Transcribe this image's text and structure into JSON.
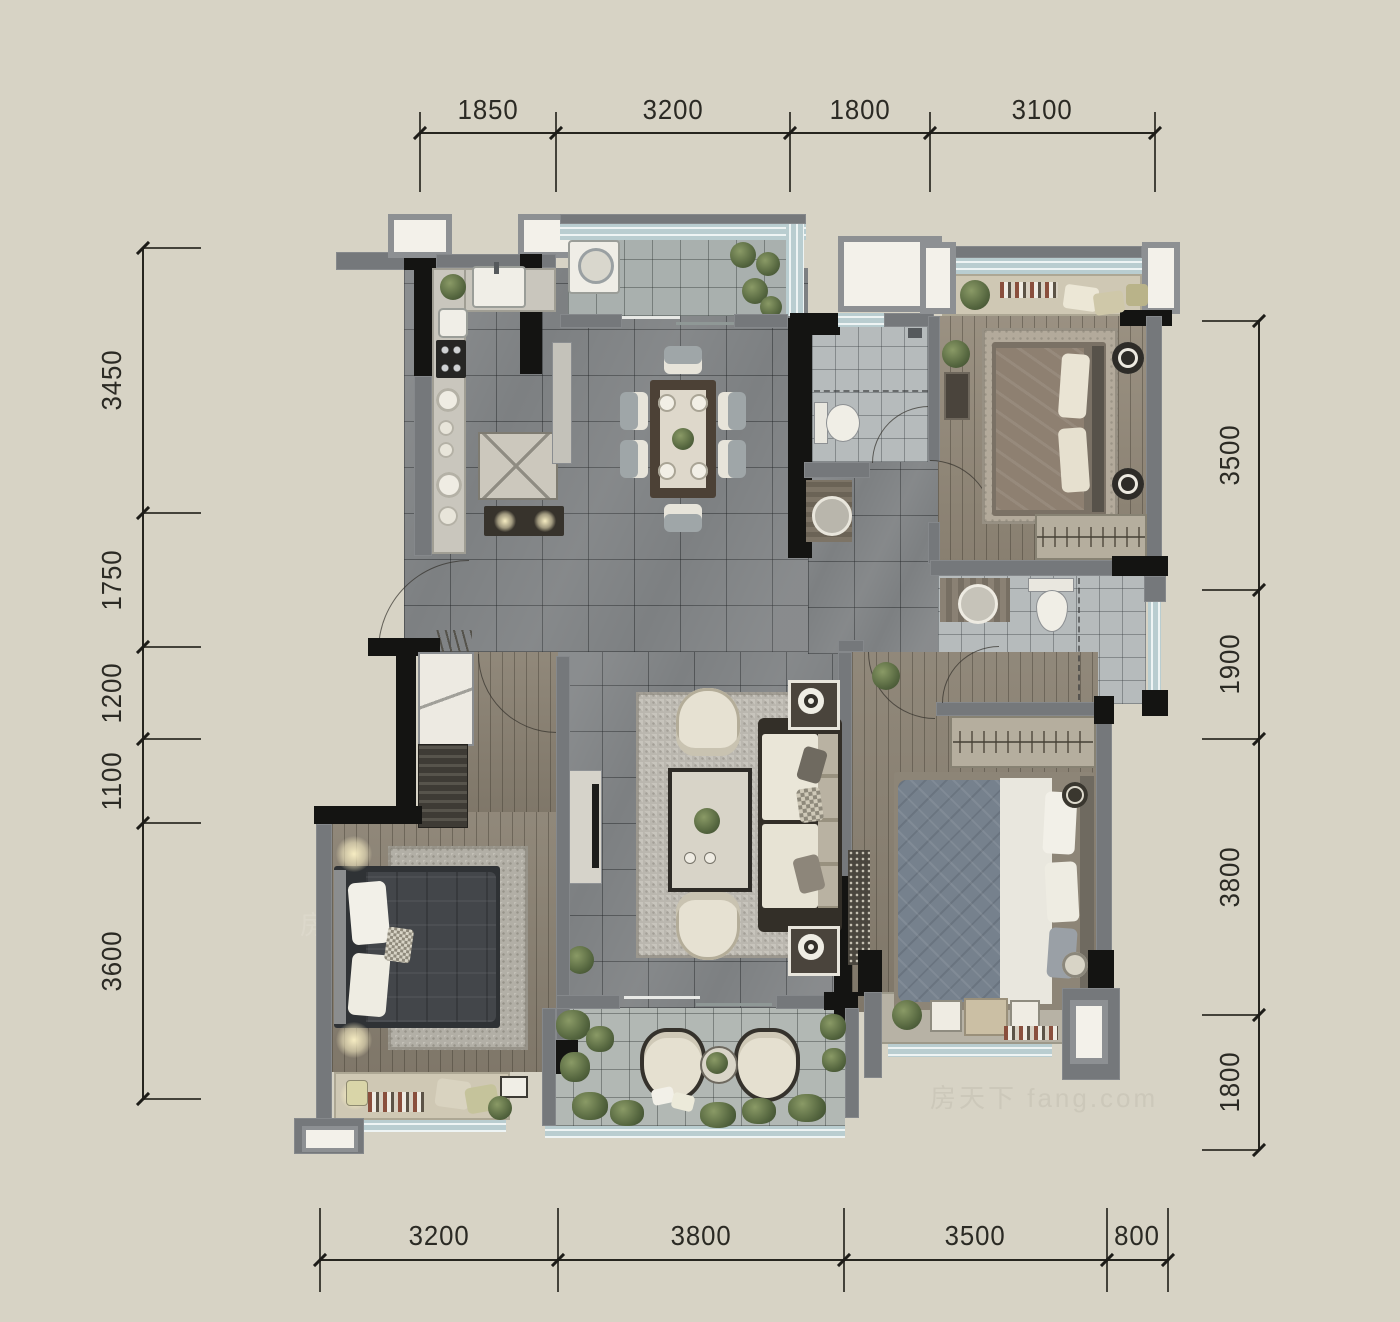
{
  "watermark": {
    "text": "房天下 fang.com"
  },
  "dimensions": {
    "top": [
      "1850",
      "3200",
      "1800",
      "3100"
    ],
    "left": [
      "3450",
      "1750",
      "1200",
      "1100",
      "3600"
    ],
    "right": [
      "3500",
      "1900",
      "3800",
      "1800"
    ],
    "bottom": [
      "3200",
      "3800",
      "3500",
      "800"
    ]
  },
  "colors": {
    "background": "#d7d3c5",
    "wall_gray": "#75787b",
    "wall_black": "#141412",
    "window_glass": "#c3d4d6",
    "floor_marble": "#7d8082",
    "floor_wood": "#8a8172",
    "floor_bath_tile": "#b6bbbc",
    "bay_seat": "#cfc8b4",
    "dimension_ink": "#2b2a24",
    "plant_green": "#55663f"
  },
  "legend": {
    "furniture_icons": [
      "washing-machine",
      "kitchen-sink",
      "cooktop",
      "dining-table",
      "dining-chair",
      "sideboard",
      "sofa",
      "coffee-table",
      "armchair",
      "tv-console",
      "side-table-lamp",
      "double-bed",
      "wardrobe",
      "closet",
      "toilet",
      "wash-basin",
      "shower",
      "bathtub-none",
      "lounge-chair",
      "round-table",
      "plant",
      "door-swing",
      "bay-window-seat"
    ]
  }
}
